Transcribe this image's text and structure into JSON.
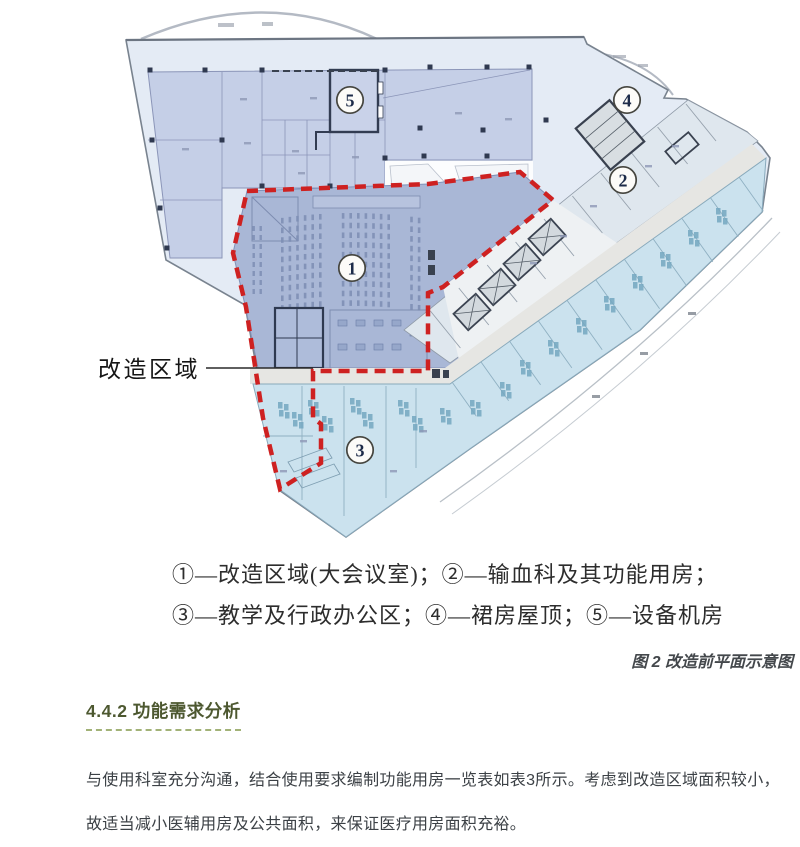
{
  "plan": {
    "area_label": "改造区域",
    "markers": [
      {
        "label": "1"
      },
      {
        "label": "2"
      },
      {
        "label": "3"
      },
      {
        "label": "4"
      },
      {
        "label": "5"
      }
    ]
  },
  "caption": {
    "line1": "①—改造区域(大会议室)；②—输血科及其功能用房；",
    "line2": "③—教学及行政办公区；④—裙房屋顶；⑤—设备机房",
    "figure_label": "图 2 改造前平面示意图"
  },
  "section": {
    "heading": "4.4.2 功能需求分析",
    "body_lines": [
      "与使用科室充分沟通，结合使用要求编制功能用房一览表如表3所示。考虑到改造区域面积较小，",
      "故适当减小医辅用房及公共面积，来保证医疗用房面积充裕。"
    ]
  },
  "colors": {
    "boundary_red": "#ce2121",
    "region1_blue": "#a9b7d6",
    "region2_band": "#dfe7ee",
    "region3_teal": "#cbe2ee",
    "roof_pale": "#e4ebf5",
    "equipment_lavender": "#c5cfe7",
    "heading_olive": "#4d5830",
    "heading_underline": "#a2b277"
  }
}
